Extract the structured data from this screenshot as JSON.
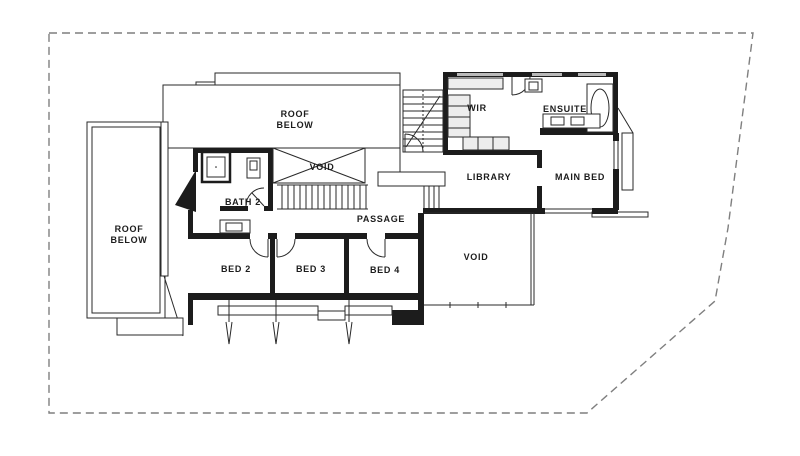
{
  "rooms": {
    "roof_top_1": "ROOF",
    "roof_top_2": "BELOW",
    "roof_left_1": "ROOF",
    "roof_left_2": "BELOW",
    "wir": "WIR",
    "ensuite": "ENSUITE",
    "library": "LIBRARY",
    "main_bed": "MAIN BED",
    "bath2": "BATH 2",
    "passage": "PASSAGE",
    "void_stair": "VOID",
    "void_right": "VOID",
    "bed2": "BED 2",
    "bed3": "BED 3",
    "bed4": "BED 4"
  },
  "colors": {
    "wall": "#1c1c1c",
    "boundary_dashed": "#7f7f7f",
    "window_fill": "#b9b9b9",
    "background": "#ffffff"
  }
}
